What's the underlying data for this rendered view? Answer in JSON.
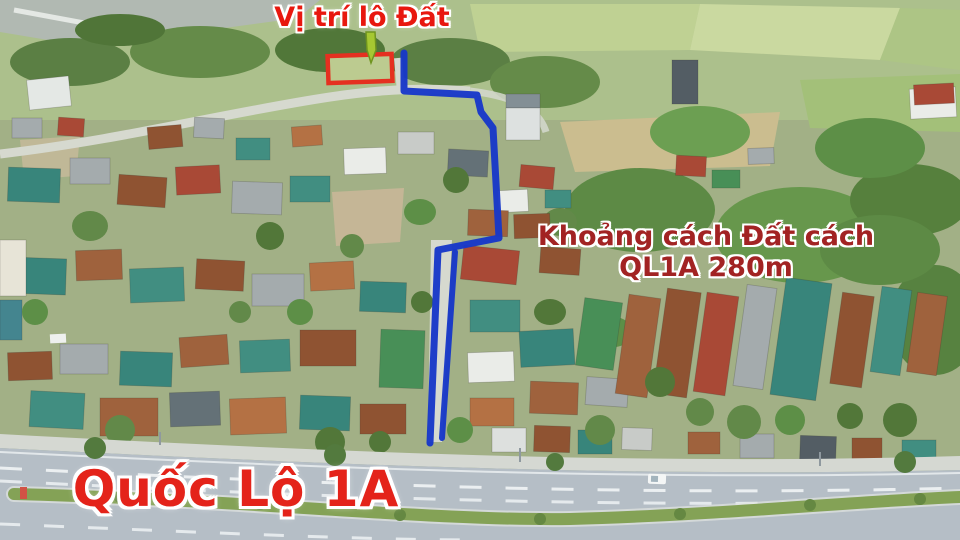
{
  "annotations": {
    "plot_label": "Vị trí lô Đất",
    "distance_line1": "Khoảng cách Đất cách",
    "distance_line2": "QL1A 280m",
    "highway_label": "Quốc Lộ 1A"
  },
  "colors": {
    "label-red": "#e8180f",
    "distance-red": "#a22323",
    "highway-red": "#e4231a",
    "route-blue": "#1737c9",
    "plot-red": "#e53020",
    "arrow-green": "#a6c832"
  }
}
